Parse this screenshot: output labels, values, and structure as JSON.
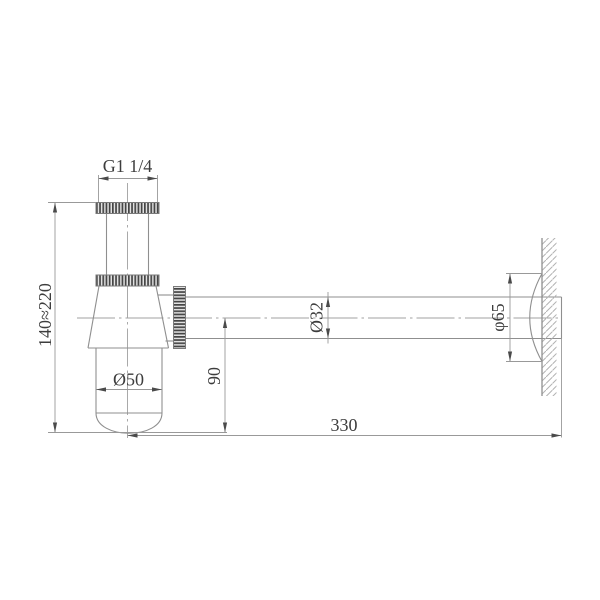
{
  "labels": {
    "thread_size": "G1 1/4",
    "height_range": "140≈220",
    "cup_diameter": "Ø50",
    "outlet_drop": "90",
    "pipe_diameter": "Ø32",
    "flange_diameter": "φ65",
    "wall_distance": "330"
  },
  "colors": {
    "background": "#ffffff",
    "geometry_line": "#8f8f8f",
    "dimension_line": "#999999",
    "text": "#3d3d3d",
    "knurl_dark": "#454545",
    "knurl_light": "#e2e2e2"
  }
}
